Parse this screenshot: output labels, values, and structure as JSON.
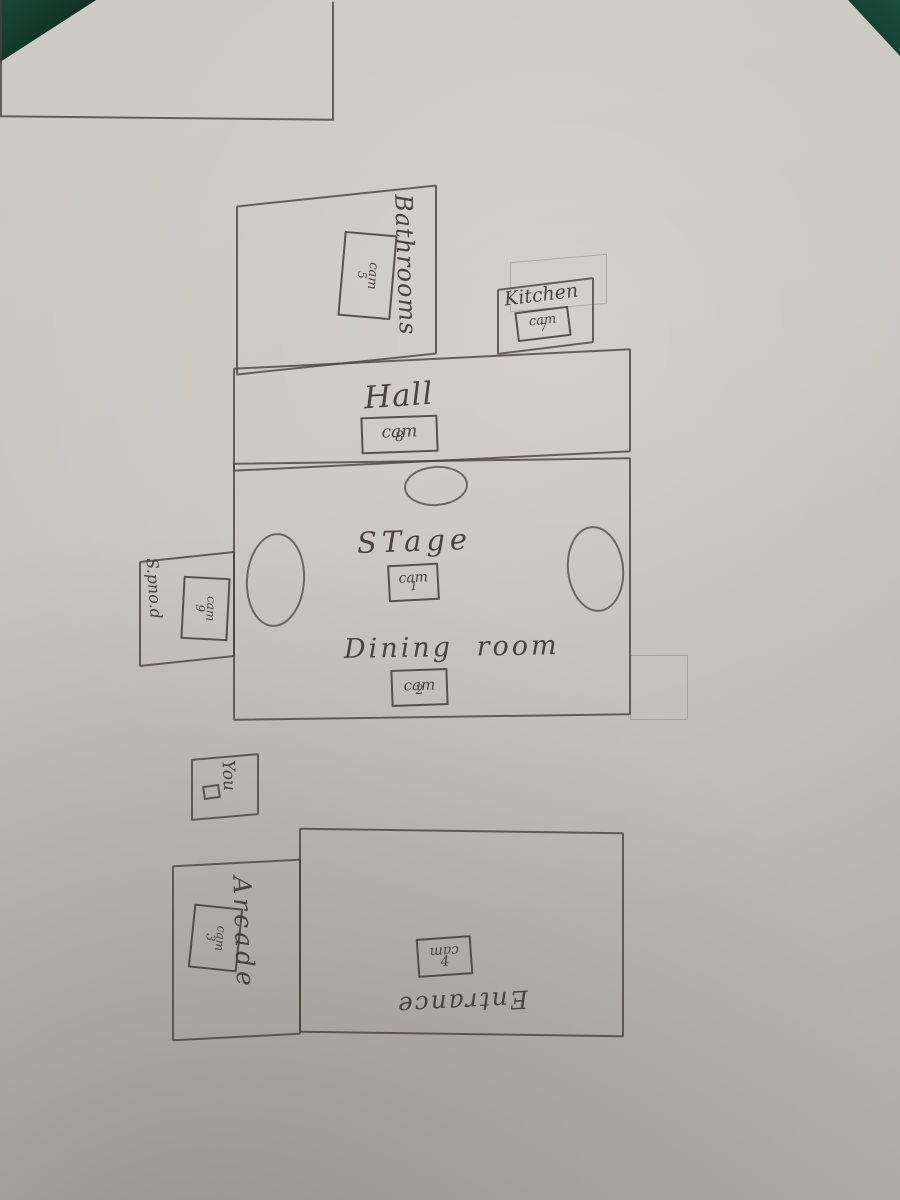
{
  "scene": {
    "description": "Hand-drawn pencil camera map on paper photographed over a dark green table",
    "surface_color": "#174434",
    "paper_color": "#c8c5bf",
    "pencil_color": "#4a443b"
  },
  "rooms": {
    "bathrooms": {
      "label": "Bathrooms",
      "cam_word": "cam",
      "cam_number": "5"
    },
    "kitchen": {
      "label": "Kitchen",
      "cam_word": "cam",
      "cam_number": "7"
    },
    "hall": {
      "label": "Hall",
      "cam_word": "cam",
      "cam_number": "8"
    },
    "stage": {
      "label": "STage",
      "cam_word": "cam",
      "cam_number": "1"
    },
    "dining": {
      "label": "Dining room",
      "cam_word": "cam",
      "cam_number": "2"
    },
    "side": {
      "label": "S.pno.d",
      "cam_word": "cam",
      "cam_number": "9"
    },
    "you": {
      "label": "You"
    },
    "arcade": {
      "label": "Arcade",
      "cam_word": "cam",
      "cam_number": "3"
    },
    "entrance": {
      "label": "Entrance",
      "cam_word": "cam",
      "cam_number": "4"
    }
  }
}
